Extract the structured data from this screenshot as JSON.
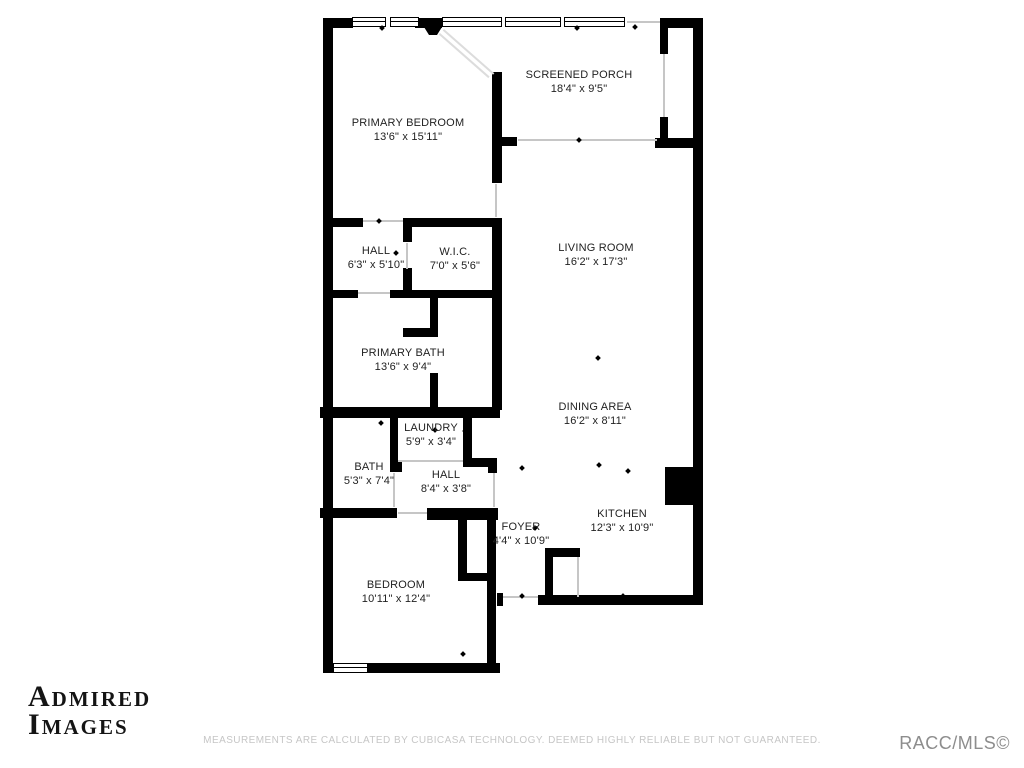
{
  "rooms": {
    "primary_bedroom": {
      "name": "PRIMARY BEDROOM",
      "dims": "13'6\" x 15'11\""
    },
    "screened_porch": {
      "name": "SCREENED PORCH",
      "dims": "18'4\" x 9'5\""
    },
    "living_room": {
      "name": "LIVING ROOM",
      "dims": "16'2\" x 17'3\""
    },
    "hall_upper": {
      "name": "HALL",
      "dims": "6'3\" x 5'10\""
    },
    "wic": {
      "name": "W.I.C.",
      "dims": "7'0\" x 5'6\""
    },
    "primary_bath": {
      "name": "PRIMARY BATH",
      "dims": "13'6\" x 9'4\""
    },
    "dining_area": {
      "name": "DINING AREA",
      "dims": "16'2\" x 8'11\""
    },
    "laundry": {
      "name": "LAUNDRY",
      "dims": "5'9\" x 3'4\""
    },
    "bath": {
      "name": "BATH",
      "dims": "5'3\" x 7'4\""
    },
    "hall_lower": {
      "name": "HALL",
      "dims": "8'4\" x 3'8\""
    },
    "foyer": {
      "name": "FOYER",
      "dims": "4'4\" x 10'9\""
    },
    "kitchen": {
      "name": "KITCHEN",
      "dims": "12'3\" x 10'9\""
    },
    "bedroom": {
      "name": "BEDROOM",
      "dims": "10'11\" x 12'4\""
    }
  },
  "watermark": {
    "line1": "ADMIRED",
    "line2": "IMAGES"
  },
  "footer": {
    "disclaimer": "MEASUREMENTS ARE CALCULATED BY CUBICASA TECHNOLOGY. DEEMED HIGHLY RELIABLE BUT NOT GUARANTEED.",
    "mls_credit": "RACC/MLS©"
  },
  "colors": {
    "wall": "#000000",
    "disclaimer_text": "#c6c6c6",
    "mls_text": "#8d8d8d"
  }
}
